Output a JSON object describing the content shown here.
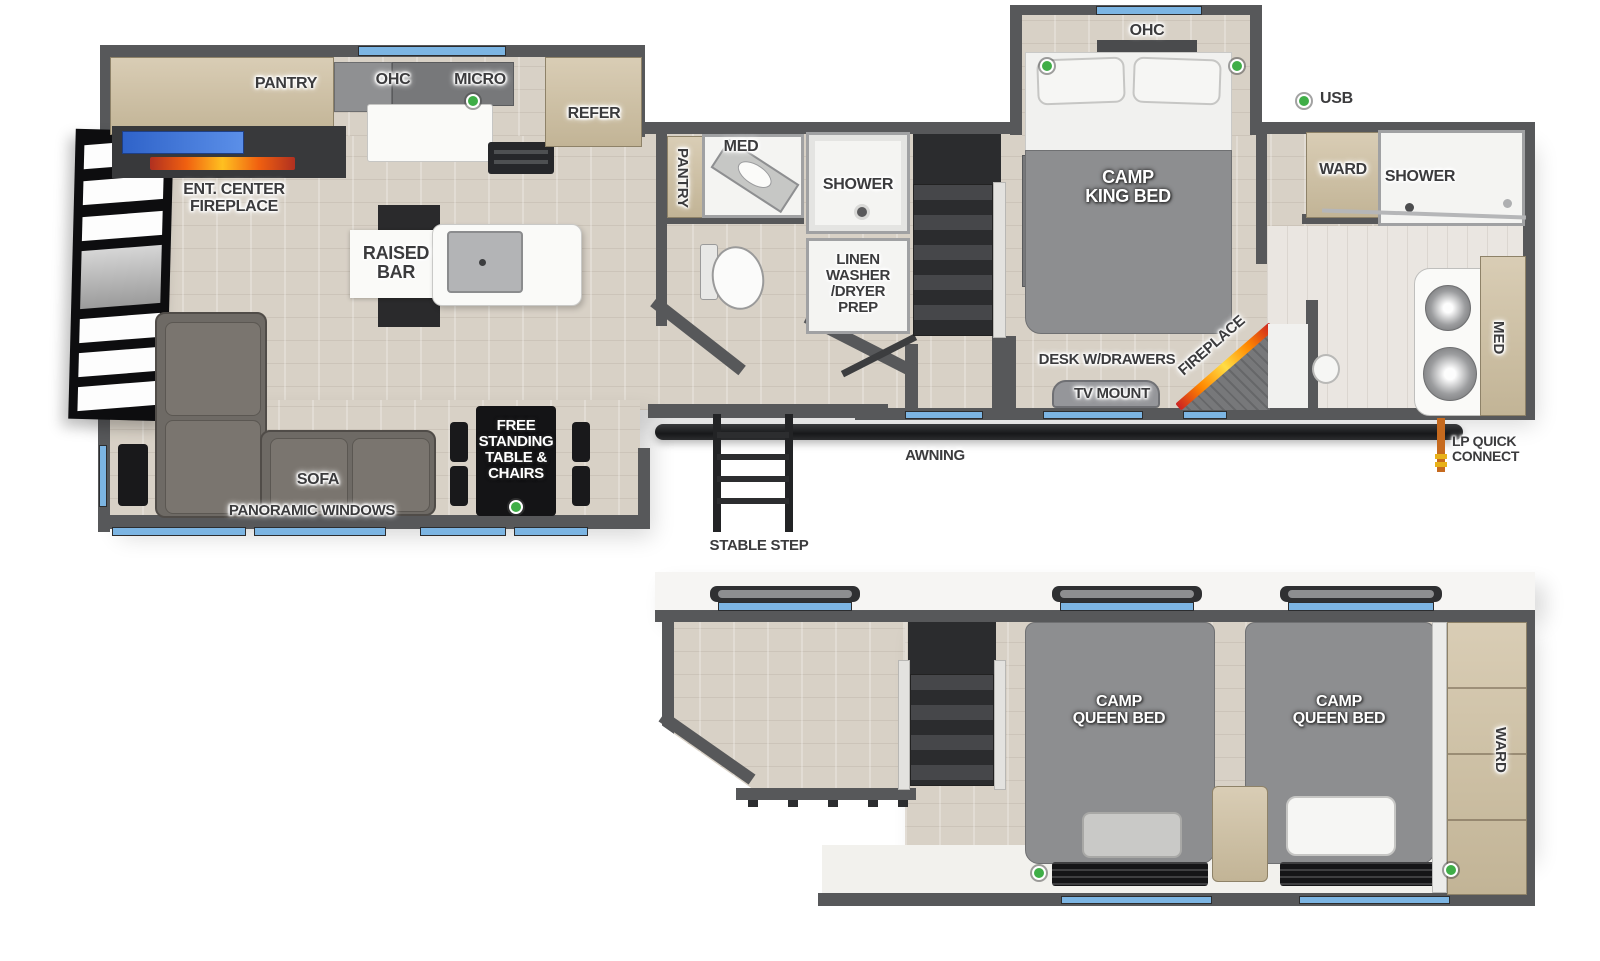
{
  "legend": {
    "usb": "USB"
  },
  "colors": {
    "wall": "#57585a",
    "window_accent": "#7cb5e3",
    "usb_dot": "#3fae47",
    "floor_wood": "#d8d1c6",
    "cabinet_tan": "#cfc3ab",
    "bed_gray": "#8d8e90",
    "flame_orange": "#ff8800",
    "tv_blue": "#3a6fd8"
  },
  "main_floor": {
    "kitchen": {
      "pantry": "PANTRY",
      "ohc": "OHC",
      "micro": "MICRO",
      "refer": "REFER"
    },
    "living": {
      "ent_center": "ENT. CENTER\nFIREPLACE",
      "raised_bar": "RAISED\nBAR",
      "sofa": "SOFA",
      "panoramic_windows": "PANORAMIC WINDOWS",
      "dinette": "FREE\nSTANDING\nTABLE &\nCHAIRS"
    },
    "bathroom": {
      "pantry": "PANTRY",
      "med": "MED",
      "shower": "SHOWER",
      "linen": "LINEN\nWASHER\n/DRYER\nPREP"
    },
    "bedroom": {
      "ohc": "OHC",
      "bed": "CAMP\nKING BED",
      "desk": "DESK W/DRAWERS",
      "tv_mount": "TV MOUNT",
      "fireplace": "FIREPLACE",
      "ward": "WARD"
    },
    "rear_bath": {
      "shower": "SHOWER",
      "med": "MED"
    },
    "exterior": {
      "awning": "AWNING",
      "stable_step": "STABLE STEP",
      "lp_quick_connect": "LP QUICK\nCONNECT"
    }
  },
  "loft": {
    "bed_left": "CAMP\nQUEEN BED",
    "bed_right": "CAMP\nQUEEN BED",
    "ward": "WARD"
  }
}
